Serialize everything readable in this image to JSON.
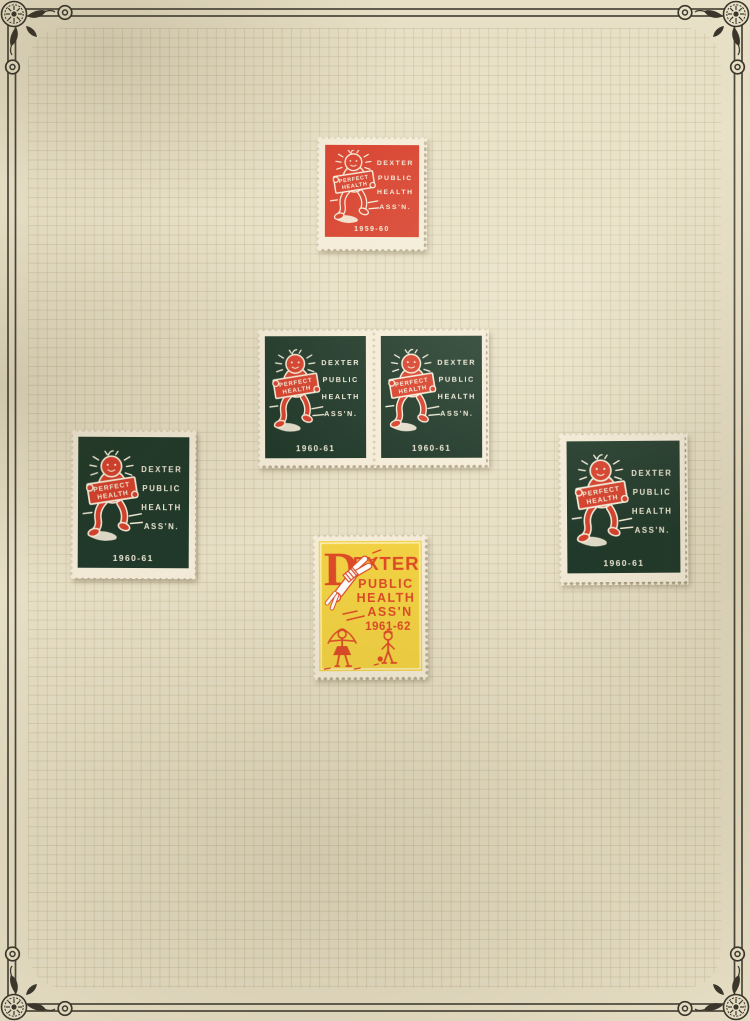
{
  "page": {
    "description": "Stamp album page of Dexter Public Health Ass'n charity seals",
    "paper_color": "#e8e0c6",
    "grid_line_color": "#948056",
    "border_ink_color": "#3a362c"
  },
  "seal_text": {
    "org": [
      "DEXTER",
      "PUBLIC",
      "HEALTH",
      "ASS'N."
    ],
    "sign": [
      "PERFECT",
      "HEALTH"
    ]
  },
  "stamps": {
    "red_single": {
      "year": "1959-60",
      "art_color": "#d7402c",
      "ink_color": "#f6efdc"
    },
    "pair_left": {
      "year": "1960-61",
      "art_color": "#20392a",
      "ink_color": "#f6efdc"
    },
    "pair_right": {
      "year": "1960-61",
      "art_color": "#20392a",
      "ink_color": "#f6efdc"
    },
    "green_left": {
      "year": "1960-61",
      "art_color": "#20392a",
      "ink_color": "#f6efdc"
    },
    "green_right": {
      "year": "1960-61",
      "art_color": "#20392a",
      "ink_color": "#f6efdc"
    },
    "yellow_single": {
      "big_letter": "D",
      "title_rest": "EXTER",
      "lines": [
        "PUBLIC",
        "HEALTH",
        "ASS'N"
      ],
      "year": "1961-62",
      "art_color": "#f2d243",
      "ink_color": "#de4a27"
    }
  }
}
